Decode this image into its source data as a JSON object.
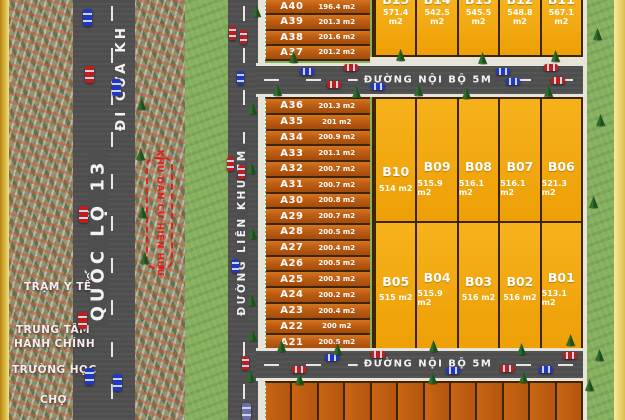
{
  "colors": {
    "a_plot": "#bc5c12",
    "b_plot": "#f0a70e",
    "plot_border": "#3f2400",
    "road": "#4e4e4e",
    "grass": "#86af5e",
    "sidewalk": "#e7e4da",
    "gold_dark": "#c9952b",
    "gold_light": "#f6eb9a",
    "accent_red": "#e31e1e"
  },
  "pois": {
    "clinic": "TRẠM Y TẾ",
    "admin_line1": "TRUNG TÂM",
    "admin_line2": "HÀNH CHÍNH",
    "school": "TRƯỜNG HỌC",
    "market": "CHỢ"
  },
  "roads": {
    "highway_label": "QUỐC LỘ 13",
    "highway_direction": "ĐI CỬA KH",
    "connector_label": "ĐƯỜNG LIÊN KHU 7M",
    "internal_top_label": "ĐƯỜNG NỘI BỘ 5M",
    "internal_bottom_label": "ĐƯỜNG NỘI BỘ 5M"
  },
  "existing_area_label": "KHU DÂN CƯ HIỆN HỮU",
  "plots": {
    "a_top": [
      {
        "id": "A40",
        "area": "196.4 m2"
      },
      {
        "id": "A39",
        "area": "201.3 m2"
      },
      {
        "id": "A38",
        "area": "201.6 m2"
      },
      {
        "id": "A37",
        "area": "201.2 m2"
      }
    ],
    "a_main": [
      {
        "id": "A36",
        "area": "201.3 m2"
      },
      {
        "id": "A35",
        "area": "201 m2"
      },
      {
        "id": "A34",
        "area": "200.9 m2"
      },
      {
        "id": "A33",
        "area": "201.1 m2"
      },
      {
        "id": "A32",
        "area": "200.7 m2"
      },
      {
        "id": "A31",
        "area": "200.7 m2"
      },
      {
        "id": "A30",
        "area": "200.8 m2"
      },
      {
        "id": "A29",
        "area": "200.7 m2"
      },
      {
        "id": "A28",
        "area": "200.5 m2"
      },
      {
        "id": "A27",
        "area": "200.4 m2"
      },
      {
        "id": "A26",
        "area": "200.5 m2"
      },
      {
        "id": "A25",
        "area": "200.3 m2"
      },
      {
        "id": "A24",
        "area": "200.2 m2"
      },
      {
        "id": "A23",
        "area": "200.4 m2"
      },
      {
        "id": "A22",
        "area": "200 m2"
      },
      {
        "id": "A21",
        "area": "200.5 m2"
      }
    ],
    "b_top": [
      {
        "id": "B15",
        "area": "571.4 m2"
      },
      {
        "id": "B14",
        "area": "542.5 m2"
      },
      {
        "id": "B13",
        "area": "545.5 m2"
      },
      {
        "id": "B12",
        "area": "548.8 m2"
      },
      {
        "id": "B11",
        "area": "567.1 m2"
      }
    ],
    "b_upper": [
      {
        "id": "B10",
        "area": "514 m2"
      },
      {
        "id": "B09",
        "area": "515.9 m2"
      },
      {
        "id": "B08",
        "area": "516.1 m2"
      },
      {
        "id": "B07",
        "area": "516.1 m2"
      },
      {
        "id": "B06",
        "area": "521.3 m2"
      }
    ],
    "b_lower": [
      {
        "id": "B05",
        "area": "515 m2"
      },
      {
        "id": "B04",
        "area": "515.9 m2"
      },
      {
        "id": "B03",
        "area": "516 m2"
      },
      {
        "id": "B02",
        "area": "516 m2"
      },
      {
        "id": "B01",
        "area": "513.1 m2"
      }
    ]
  }
}
